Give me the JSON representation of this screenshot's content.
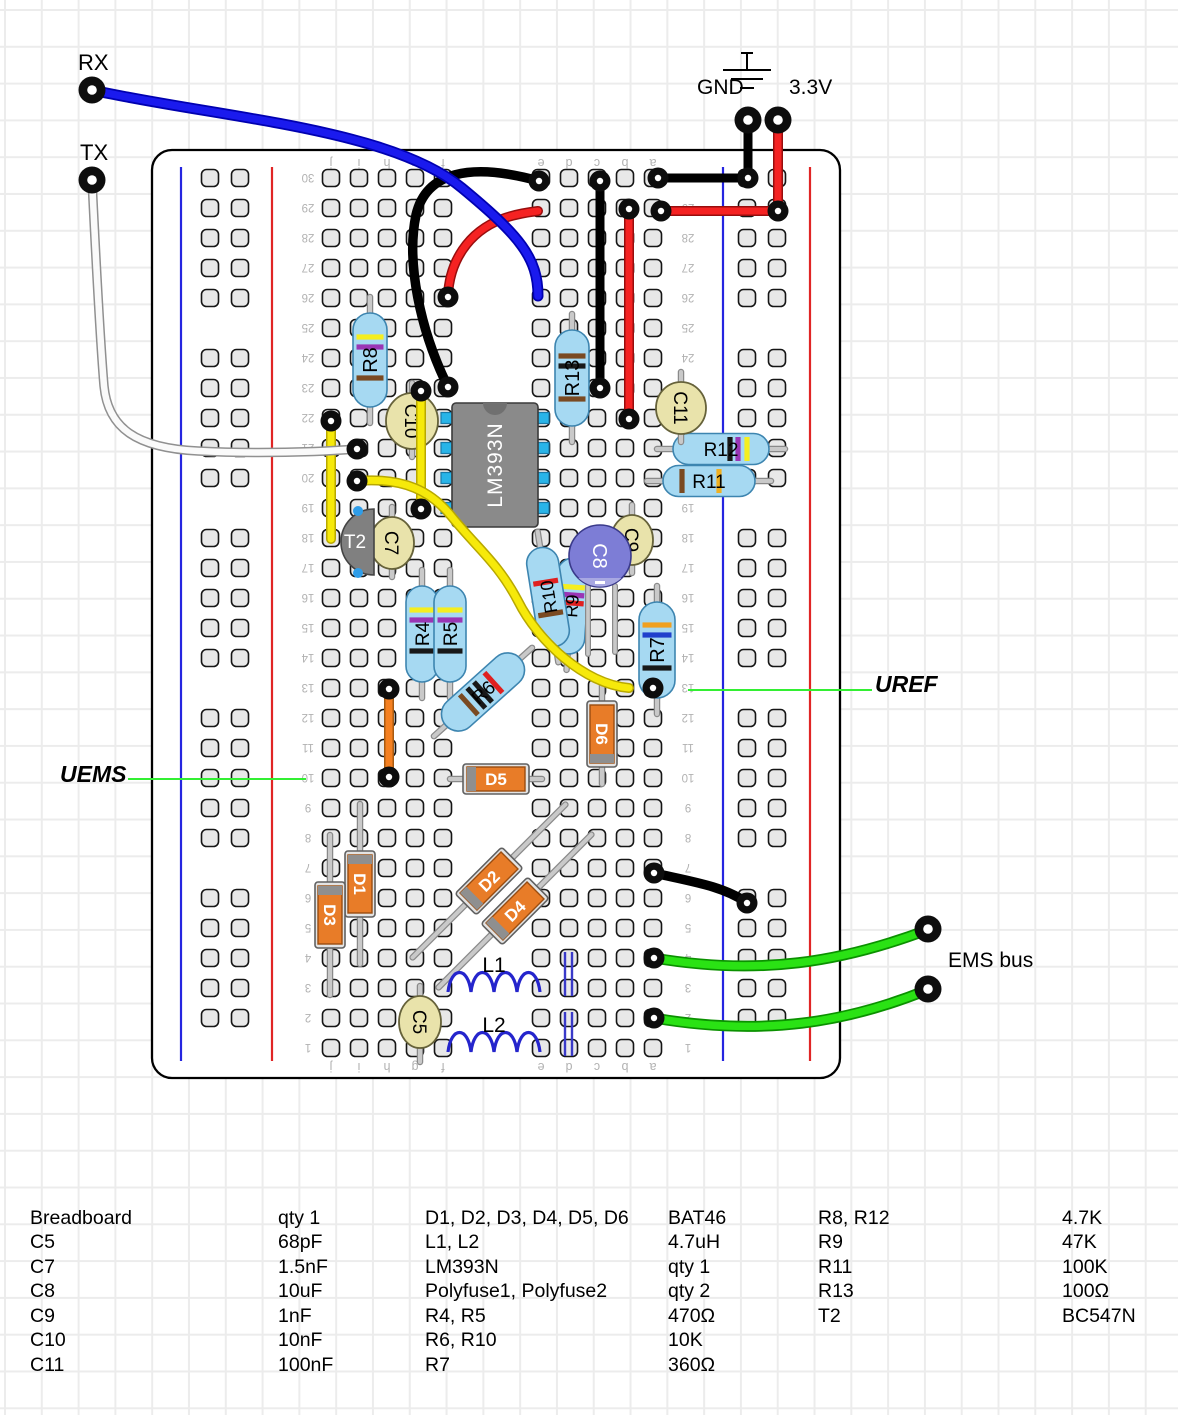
{
  "page_labels": {
    "rx": "RX",
    "tx": "TX",
    "gnd": "GND",
    "v33": "3.3V",
    "uems": "UEMS",
    "uref": "UREF",
    "ems_bus": "EMS bus"
  },
  "breadboard": {
    "row_min": 1,
    "row_max": 30,
    "column_letters_left": [
      "j",
      "i",
      "h",
      "g",
      "f"
    ],
    "column_letters_right": [
      "e",
      "d",
      "c",
      "b",
      "a"
    ]
  },
  "components": {
    "ic": {
      "id": "IC1",
      "label": "LM393N"
    },
    "transistor": {
      "id": "T2",
      "label": "T2"
    },
    "resistors": [
      {
        "id": "R8",
        "label": "R8"
      },
      {
        "id": "R13",
        "label": "R13"
      },
      {
        "id": "R12",
        "label": "R12"
      },
      {
        "id": "R11",
        "label": "R11"
      },
      {
        "id": "R4",
        "label": "R4"
      },
      {
        "id": "R5",
        "label": "R5"
      },
      {
        "id": "R6",
        "label": "R6"
      },
      {
        "id": "R9",
        "label": "R9"
      },
      {
        "id": "R10",
        "label": "R10"
      },
      {
        "id": "R7",
        "label": "R7"
      }
    ],
    "capacitors": [
      {
        "id": "C10",
        "label": "C10"
      },
      {
        "id": "C11",
        "label": "C11"
      },
      {
        "id": "C7",
        "label": "C7"
      },
      {
        "id": "C9",
        "label": "C9"
      },
      {
        "id": "C8",
        "label": "C8"
      },
      {
        "id": "C5",
        "label": "C5"
      }
    ],
    "diodes": [
      {
        "id": "D1",
        "label": "D1"
      },
      {
        "id": "D2",
        "label": "D2"
      },
      {
        "id": "D3",
        "label": "D3"
      },
      {
        "id": "D4",
        "label": "D4"
      },
      {
        "id": "D5",
        "label": "D5"
      },
      {
        "id": "D6",
        "label": "D6"
      }
    ],
    "inductors": [
      {
        "id": "L1",
        "label": "L1"
      },
      {
        "id": "L2",
        "label": "L2"
      }
    ]
  },
  "wires": [
    {
      "id": "rx-wire",
      "color": "#1a1aee"
    },
    {
      "id": "tx-wire",
      "color": "#fafafa"
    },
    {
      "id": "gnd-wire",
      "color": "#0a0a0a"
    },
    {
      "id": "gnd-row-wire",
      "color": "#0a0a0a"
    },
    {
      "id": "black-column-wire",
      "color": "#0a0a0a"
    },
    {
      "id": "black-arc-wire",
      "color": "#0a0a0a"
    },
    {
      "id": "black-bottom-wire",
      "color": "#0a0a0a"
    },
    {
      "id": "v33-wire",
      "color": "#f52222"
    },
    {
      "id": "v33-row-wire",
      "color": "#f52222"
    },
    {
      "id": "red-column-wire",
      "color": "#f52222"
    },
    {
      "id": "red-arc-wire",
      "color": "#f52222"
    },
    {
      "id": "yellow-left-wire",
      "color": "#f6e90a"
    },
    {
      "id": "yellow-mid-wire",
      "color": "#f6e90a"
    },
    {
      "id": "yellow-long-wire",
      "color": "#f6e90a"
    },
    {
      "id": "orange-jumper-wire",
      "color": "#f58020"
    },
    {
      "id": "ems-wire-1",
      "color": "#2ae214"
    },
    {
      "id": "ems-wire-2",
      "color": "#2ae214"
    }
  ],
  "callouts": {
    "uems_color": "#33ef33",
    "uref_color": "#33ef33"
  },
  "rail_colors": {
    "blue": "#2525e0",
    "red": "#e02525"
  },
  "parts_list": {
    "rows": [
      [
        "Breadboard",
        "qty 1",
        "D1, D2, D3, D4, D5, D6",
        "BAT46",
        "R8, R12",
        "4.7K"
      ],
      [
        "C5",
        "68pF",
        "L1, L2",
        "4.7uH",
        "R9",
        "47K"
      ],
      [
        "C7",
        "1.5nF",
        "LM393N",
        "qty 1",
        "R11",
        "100K"
      ],
      [
        "C8",
        "10uF",
        "Polyfuse1, Polyfuse2",
        "qty 2",
        "R13",
        "100Ω"
      ],
      [
        "C9",
        "1nF",
        "R4, R5",
        "470Ω",
        "T2",
        "BC547N"
      ],
      [
        "C10",
        "10nF",
        "R6, R10",
        "10K",
        "",
        ""
      ],
      [
        "C11",
        "100nF",
        "R7",
        "360Ω",
        "",
        ""
      ]
    ]
  }
}
